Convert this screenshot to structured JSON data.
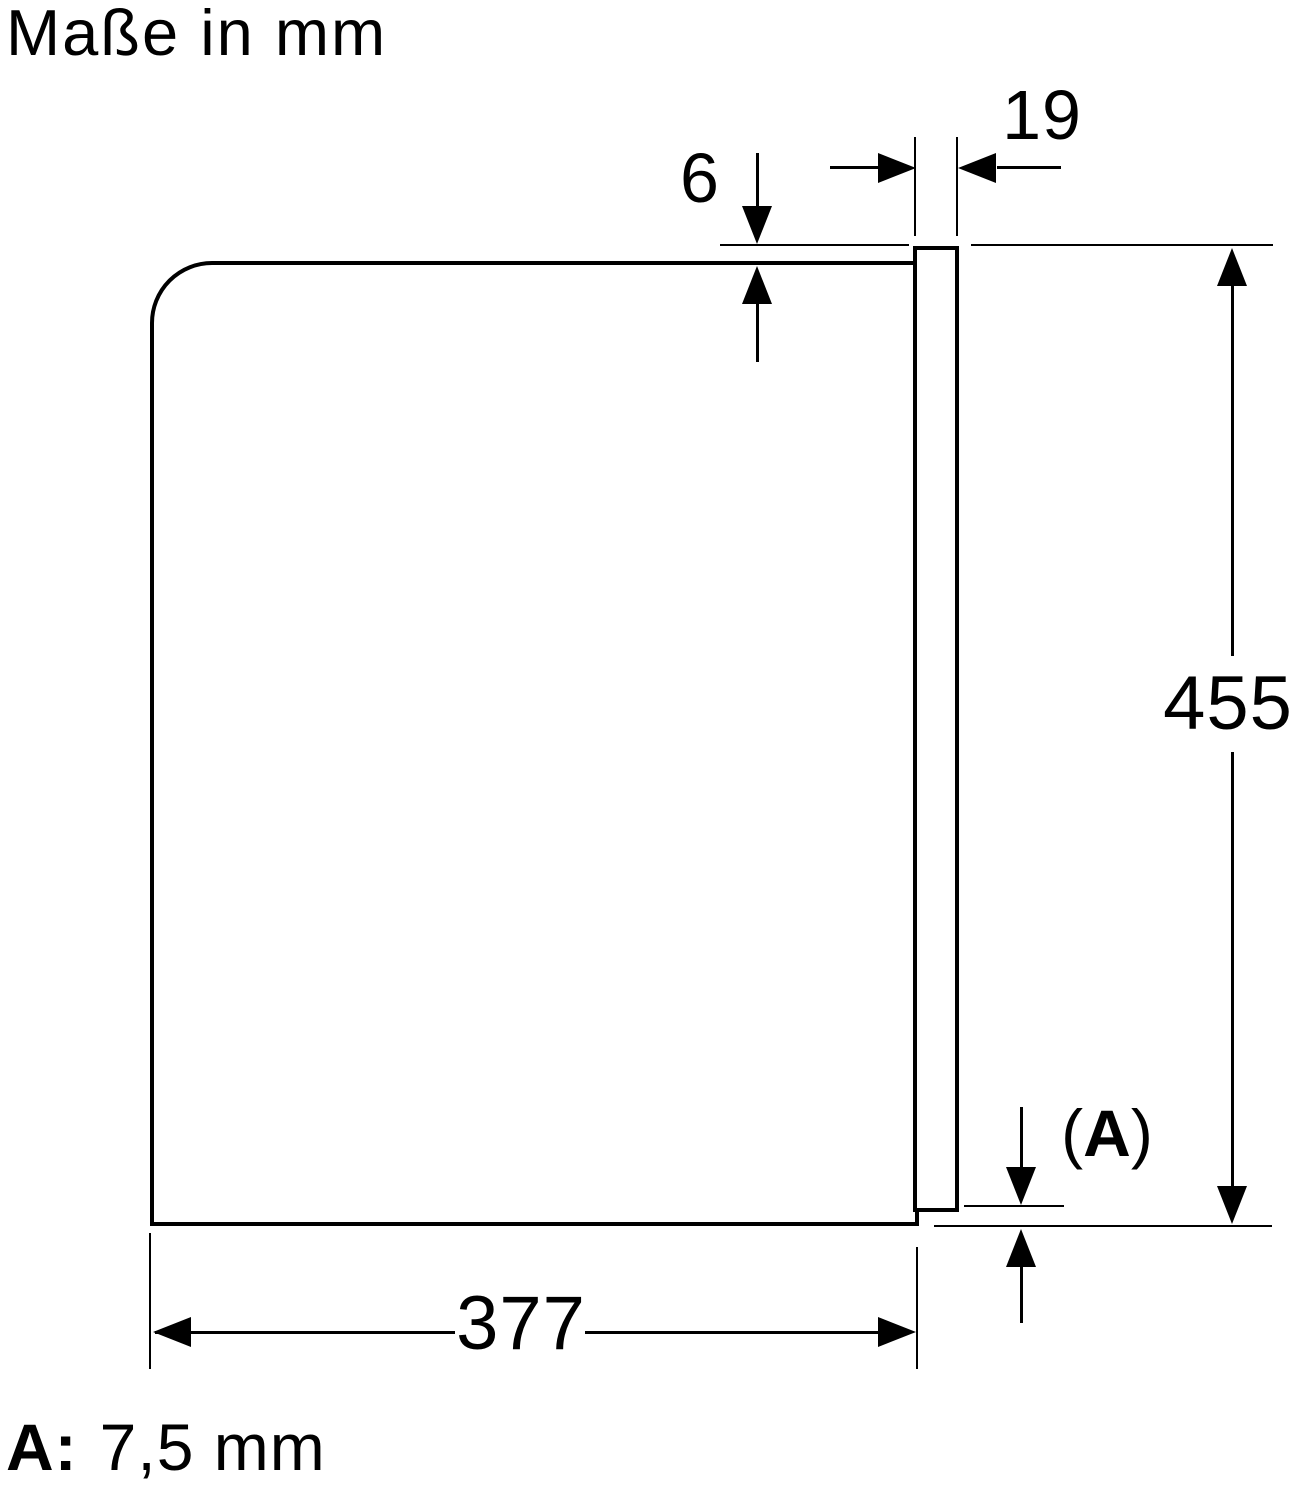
{
  "title": "Maße in mm",
  "diagram": {
    "door_thickness_mm": "19",
    "top_overhang_mm": "6",
    "height_mm": "455",
    "depth_mm": "377",
    "rear_gap": {
      "open": "(",
      "letter": "A",
      "close": ")"
    }
  },
  "legend": {
    "label": "A:",
    "value": "7,5 mm"
  },
  "colors": {
    "ink": "#000000",
    "paper": "#ffffff"
  }
}
